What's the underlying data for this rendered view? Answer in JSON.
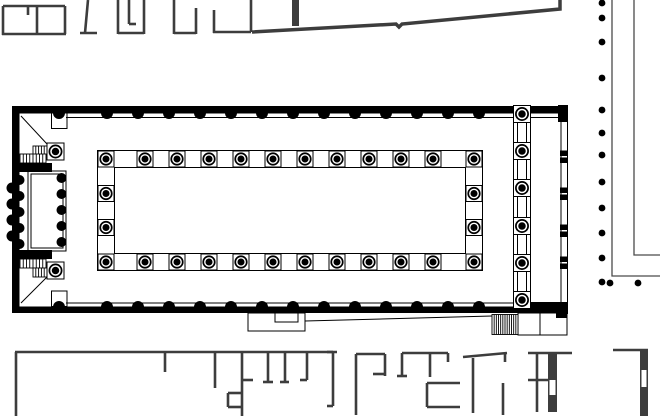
{
  "canvas": {
    "width": 660,
    "height": 416,
    "background": "#ffffff"
  },
  "palette": {
    "ink": "#000000",
    "context_wall": "#3d3d3d",
    "portico_line": "#4a4a4a",
    "white": "#ffffff"
  },
  "figure": {
    "kind": "architectural-floor-plan",
    "subject": "basilica-with-forum-portico-and-surrounding-buildings"
  },
  "groups": [
    {
      "name": "north-shops",
      "stroke": "#3d3d3d",
      "sw": 2.6,
      "fill": "#3d3d3d",
      "shapes": [
        [
          "l",
          3,
          6,
          65,
          6
        ],
        [
          "l",
          3,
          6,
          3,
          35
        ],
        [
          "l",
          37,
          6,
          37,
          34
        ],
        [
          "l",
          65,
          6,
          65,
          34
        ],
        [
          "l",
          2,
          34,
          66,
          34
        ],
        [
          "l",
          28,
          6,
          28,
          15
        ],
        [
          "l",
          88,
          0,
          85,
          33
        ],
        [
          "l",
          80,
          33,
          97,
          33
        ],
        [
          "l",
          118,
          0,
          118,
          34
        ],
        [
          "l",
          118,
          33,
          144,
          33
        ],
        [
          "l",
          144,
          0,
          144,
          34
        ],
        [
          "l",
          129,
          0,
          129,
          24
        ],
        [
          "l",
          129,
          24,
          136,
          24
        ],
        [
          "l",
          174,
          0,
          174,
          34
        ],
        [
          "l",
          174,
          33,
          196,
          33
        ],
        [
          "l",
          196,
          8,
          196,
          34
        ],
        [
          "l",
          214,
          10,
          214,
          33
        ],
        [
          "l",
          213,
          32,
          251,
          32
        ],
        [
          "l",
          251,
          0,
          251,
          32
        ]
      ]
    },
    {
      "name": "precinct-boundary-wall",
      "stroke": "#3d3d3d",
      "sw": 3.5,
      "fill": "#3d3d3d",
      "shapes": [
        [
          "pl",
          [
            [
              252,
              32
            ],
            [
              396,
              24
            ],
            [
              399,
              27
            ],
            [
              402,
              24
            ],
            [
              560,
              9
            ],
            [
              560,
              0
            ]
          ]
        ],
        [
          "fr",
          292,
          0,
          7,
          26
        ]
      ]
    },
    {
      "name": "south-complex",
      "stroke": "#3d3d3d",
      "sw": 2.6,
      "fill": "#3d3d3d",
      "shapes": [
        [
          "l",
          15,
          352,
          337,
          352
        ],
        [
          "l",
          16,
          352,
          16,
          416
        ],
        [
          "l",
          165,
          352,
          165,
          372
        ],
        [
          "l",
          215,
          352,
          215,
          388
        ],
        [
          "l",
          242,
          352,
          242,
          416
        ],
        [
          "l",
          242,
          380,
          253,
          380
        ],
        [
          "l",
          228,
          393,
          242,
          393
        ],
        [
          "l",
          228,
          393,
          228,
          407
        ],
        [
          "l",
          228,
          407,
          242,
          407
        ],
        [
          "l",
          268,
          352,
          268,
          382
        ],
        [
          "l",
          263,
          382,
          273,
          382
        ],
        [
          "l",
          285,
          352,
          285,
          382
        ],
        [
          "l",
          280,
          382,
          289,
          382
        ],
        [
          "l",
          307,
          352,
          307,
          380
        ],
        [
          "l",
          300,
          380,
          307,
          380
        ],
        [
          "l",
          327,
          352,
          333,
          352
        ],
        [
          "l",
          333,
          352,
          333,
          406
        ],
        [
          "l",
          327,
          406,
          333,
          406
        ],
        [
          "l",
          356,
          354,
          385,
          354
        ],
        [
          "l",
          356,
          354,
          356,
          415
        ],
        [
          "l",
          385,
          354,
          385,
          376
        ],
        [
          "l",
          373,
          374,
          385,
          374
        ],
        [
          "l",
          402,
          353,
          448,
          353
        ],
        [
          "l",
          402,
          353,
          402,
          376
        ],
        [
          "l",
          397,
          376,
          407,
          376
        ],
        [
          "l",
          430,
          353,
          430,
          377
        ],
        [
          "l",
          448,
          353,
          448,
          362
        ],
        [
          "l",
          427,
          383,
          460,
          383
        ],
        [
          "l",
          427,
          383,
          427,
          407
        ],
        [
          "l",
          427,
          407,
          460,
          407
        ],
        [
          "l",
          463,
          357,
          507,
          353
        ],
        [
          "l",
          473,
          358,
          473,
          413
        ],
        [
          "l",
          505,
          353,
          505,
          362
        ],
        [
          "l",
          503,
          383,
          503,
          415
        ],
        [
          "l",
          528,
          353,
          572,
          353
        ],
        [
          "l",
          537,
          353,
          537,
          412
        ],
        [
          "l",
          528,
          380,
          548,
          380
        ],
        [
          "l",
          613,
          350,
          648,
          350
        ],
        [
          "fr",
          548,
          353,
          9,
          59
        ],
        [
          "fr",
          640,
          350,
          8,
          66
        ],
        [
          "fr",
          549.5,
          380,
          6,
          15,
          "#ffffff"
        ],
        [
          "fr",
          641.5,
          370,
          5,
          17,
          "#ffffff"
        ]
      ]
    },
    {
      "name": "forum-portico-colonnade",
      "stroke": "#4a4a4a",
      "sw": 1.3,
      "fill": "#000000",
      "shapes": [
        [
          "pl",
          [
            [
              612,
              0
            ],
            [
              612,
              276
            ],
            [
              660,
              276
            ]
          ]
        ],
        [
          "pl",
          [
            [
              634,
              0
            ],
            [
              634,
              255
            ],
            [
              660,
              255
            ]
          ]
        ],
        [
          "cys",
          602,
          3.4,
          [
            3,
            18,
            42,
            78,
            110,
            133,
            155,
            182,
            208,
            233,
            258,
            282
          ]
        ],
        [
          "c",
          610,
          283,
          3.4
        ],
        [
          "c",
          638,
          283,
          3.4
        ]
      ]
    },
    {
      "name": "basilica-walls",
      "stroke": "#000000",
      "sw": 1,
      "fill": "#000000",
      "shapes": [
        [
          "fr",
          12,
          106,
          556,
          7.5
        ],
        [
          "fr",
          558,
          105,
          10,
          17
        ],
        [
          "fr",
          12,
          106,
          7.5,
          207
        ],
        [
          "fr",
          12,
          306.5,
          506,
          6.5
        ],
        [
          "fr",
          518,
          302,
          49,
          11
        ],
        [
          "fr",
          556,
          302,
          11,
          16
        ],
        [
          "fr",
          19,
          163,
          33,
          9
        ],
        [
          "fr",
          19,
          250,
          33,
          9
        ],
        [
          "cxs",
          113,
          6,
          [
            107,
            138,
            169,
            200,
            231,
            262,
            293,
            324,
            355,
            386,
            417,
            448,
            479
          ]
        ],
        [
          "cxs",
          307,
          6,
          [
            107,
            138,
            169,
            200,
            231,
            262,
            293,
            324,
            355,
            386,
            417,
            448,
            479
          ]
        ],
        [
          "c",
          59,
          113,
          6
        ],
        [
          "c",
          59,
          307,
          6
        ],
        [
          "s",
          12,
          188,
          5.5,
          "left"
        ],
        [
          "s",
          12,
          204,
          5.5,
          "left"
        ],
        [
          "s",
          12,
          220,
          5.5,
          "left"
        ],
        [
          "s",
          12,
          236,
          5.5,
          "left"
        ],
        [
          "s",
          19.5,
          180,
          5,
          "right"
        ],
        [
          "s",
          19.5,
          196,
          5,
          "right"
        ],
        [
          "s",
          19.5,
          212,
          5,
          "right"
        ],
        [
          "s",
          19.5,
          228,
          5,
          "right"
        ],
        [
          "s",
          19.5,
          244,
          5,
          "right"
        ],
        [
          "fr",
          560,
          150.5,
          7.5,
          5.5
        ],
        [
          "fr",
          560,
          157.5,
          7.5,
          5.5
        ],
        [
          "fr",
          560,
          187.5,
          7.5,
          5.5
        ],
        [
          "fr",
          560,
          194.5,
          7.5,
          5.5
        ],
        [
          "fr",
          560,
          224.5,
          7.5,
          5.5
        ],
        [
          "fr",
          560,
          231.5,
          7.5,
          5.5
        ],
        [
          "fr",
          560,
          256.5,
          7.5,
          5.5
        ],
        [
          "fr",
          560,
          263.5,
          7.5,
          5.5
        ]
      ]
    },
    {
      "name": "basilica-outlines",
      "stroke": "#000000",
      "sw": 1,
      "fill": "none",
      "shapes": [
        [
          "l",
          66,
          117.5,
          559,
          117.5
        ],
        [
          "l",
          66,
          303,
          518,
          303
        ],
        [
          "l",
          21,
          116,
          47,
          144
        ],
        [
          "l",
          21,
          303,
          47,
          277
        ],
        [
          "r",
          51.5,
          113,
          15.5,
          15.5
        ],
        [
          "r",
          51.5,
          291,
          15.5,
          15.5
        ],
        [
          "l",
          561,
          113,
          561,
          314
        ],
        [
          "l",
          567.5,
          113,
          567.5,
          314
        ],
        [
          "r",
          248,
          313,
          57,
          18
        ],
        [
          "r",
          275,
          313,
          23,
          9
        ],
        [
          "l",
          305,
          321,
          492,
          316
        ],
        [
          "r",
          518,
          313,
          49,
          22
        ],
        [
          "l",
          540,
          313,
          540,
          335
        ]
      ]
    },
    {
      "name": "basilica-stairs",
      "stroke": "#000000",
      "sw": 0.9,
      "fill": "none",
      "shapes": [
        [
          "h",
          33,
          146,
          14,
          9,
          4
        ],
        [
          "h",
          20,
          154,
          26,
          9,
          7
        ],
        [
          "h",
          20,
          259,
          26,
          9,
          7
        ],
        [
          "h",
          33,
          268,
          14,
          9,
          4
        ],
        [
          "h",
          492,
          314.5,
          26,
          20,
          11
        ]
      ]
    },
    {
      "name": "tribunal",
      "stroke": "#000000",
      "sw": 1,
      "fill": "#000000",
      "shapes": [
        [
          "r",
          28,
          171,
          38,
          80
        ],
        [
          "r",
          31,
          174,
          32,
          74
        ],
        [
          "s",
          34,
          171,
          5,
          "up"
        ],
        [
          "s",
          47,
          171,
          5,
          "up"
        ],
        [
          "s",
          34,
          251,
          5,
          "down"
        ],
        [
          "s",
          47,
          251,
          5,
          "down"
        ],
        [
          "cys",
          61.5,
          5,
          [
            178,
            194,
            210,
            226,
            242
          ]
        ],
        [
          "col",
          55.5,
          151.5,
          17
        ],
        [
          "col",
          55.5,
          270.5,
          17
        ]
      ]
    },
    {
      "name": "nave-peristyle",
      "stroke": "#000000",
      "sw": 1,
      "fill": "#000000",
      "shapes": [
        [
          "r",
          97.5,
          150.5,
          385,
          120
        ],
        [
          "r",
          114.5,
          167.5,
          351,
          86
        ],
        [
          "colxs",
          159,
          16,
          [
            106,
            145,
            177,
            209,
            241,
            273,
            305,
            337,
            369,
            401,
            433,
            474
          ]
        ],
        [
          "colxs",
          262,
          16,
          [
            106,
            145,
            177,
            209,
            241,
            273,
            305,
            337,
            369,
            401,
            433,
            474
          ]
        ],
        [
          "colys",
          106,
          16,
          [
            193.5,
            227.5
          ]
        ],
        [
          "colys",
          474,
          16,
          [
            193.5,
            227.5
          ]
        ]
      ]
    },
    {
      "name": "east-colonnade",
      "stroke": "#000000",
      "sw": 1,
      "fill": "#000000",
      "shapes": [
        [
          "l",
          513.5,
          107,
          513.5,
          308
        ],
        [
          "l",
          517.5,
          107,
          517.5,
          308
        ],
        [
          "l",
          526.5,
          107,
          526.5,
          308
        ],
        [
          "l",
          530.5,
          107,
          530.5,
          308
        ],
        [
          "colys",
          522,
          17,
          [
            114,
            151,
            188,
            226,
            263,
            300
          ]
        ]
      ]
    }
  ]
}
